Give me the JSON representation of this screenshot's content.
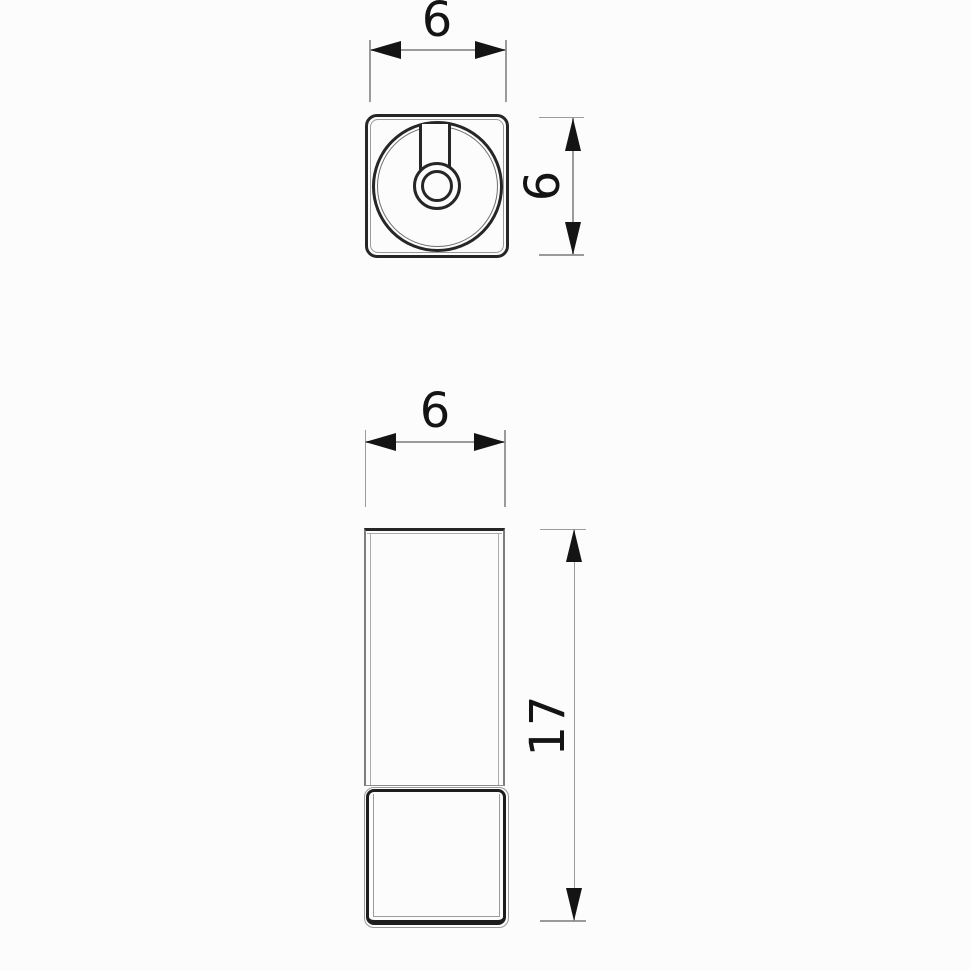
{
  "drawing": {
    "background": "#fcfcfc",
    "outline_color": "#262626",
    "thin_line_color": "#9b9b9b",
    "arrow_color": "#141414",
    "text_color": "#141414",
    "top_view": {
      "width_label": "6",
      "height_label": "6"
    },
    "front_view": {
      "width_label": "6",
      "height_label": "17"
    }
  }
}
